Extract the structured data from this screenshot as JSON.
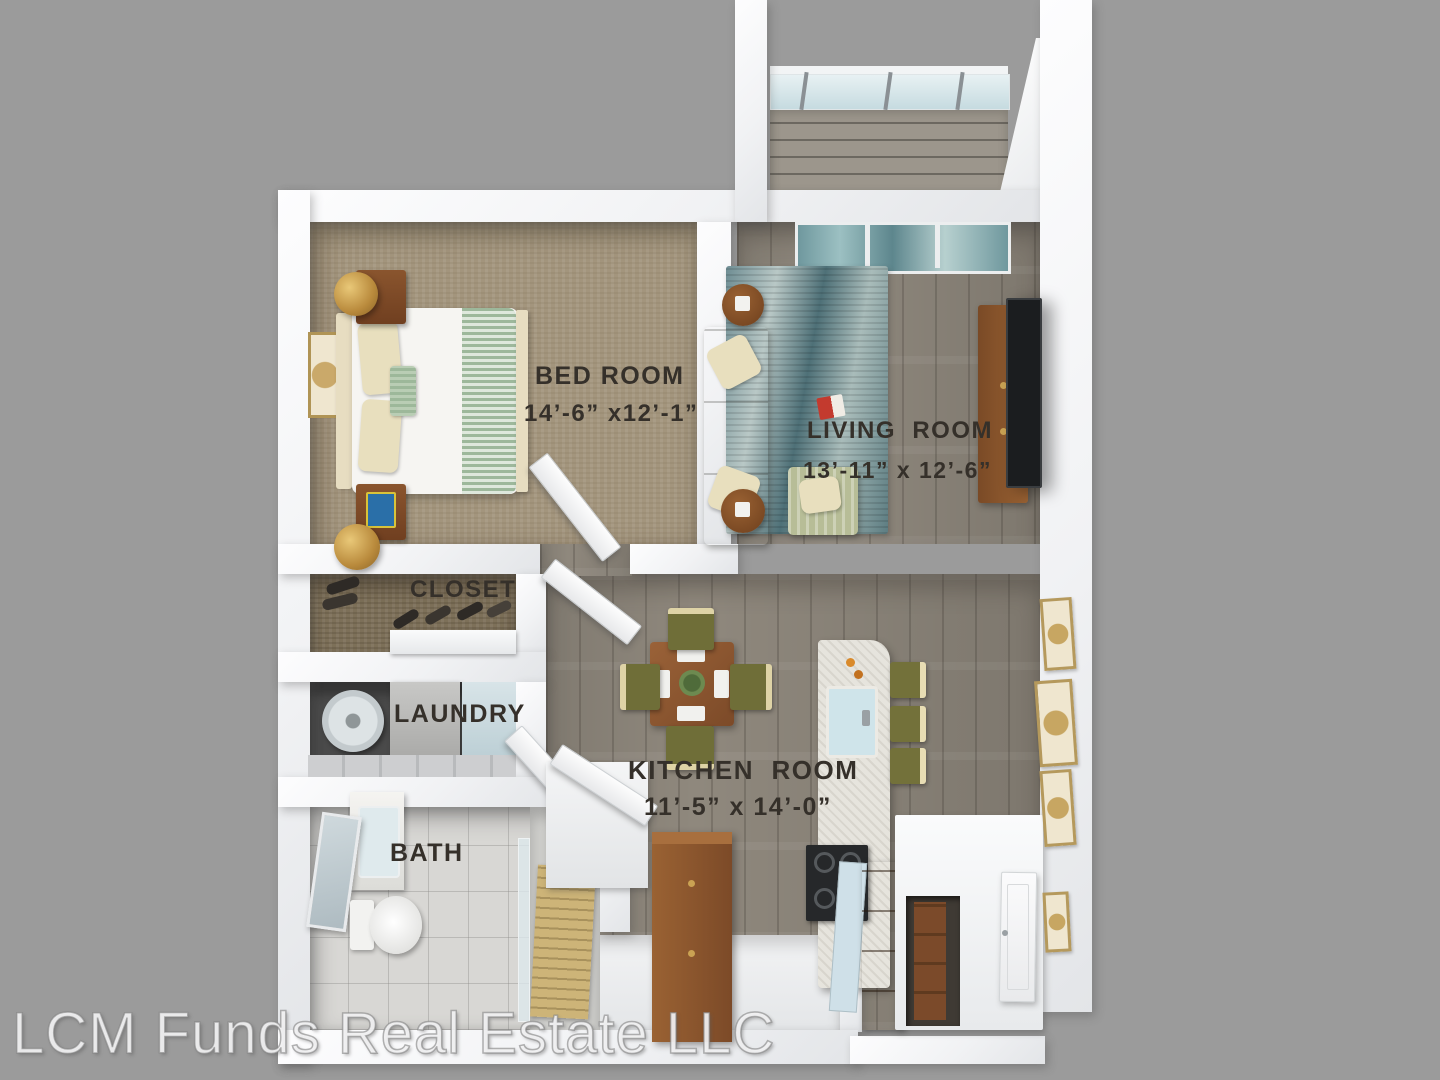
{
  "image": {
    "type": "3d-floorplan-top-view",
    "watermark": "LCM Funds Real Estate LLC",
    "background_color": "#9b9b9b",
    "wall_color": "#f4f5f7",
    "label_color": "#35302a"
  },
  "rooms": {
    "bedroom": {
      "label": "BED ROOM",
      "dimensions": "14’-6” x12’-1”"
    },
    "living": {
      "label": "LIVING  ROOM",
      "dimensions": "13’-11” x 12’-6”"
    },
    "closet": {
      "label": "CLOSET"
    },
    "laundry": {
      "label": "LAUNDRY"
    },
    "kitchen": {
      "label": "KITCHEN  ROOM",
      "dimensions": "11’-5” x 14’-0”"
    },
    "bath": {
      "label": "BATH"
    }
  },
  "palette": {
    "carpet": "#a3957d",
    "wood_floor": "#8f887d",
    "rug": "#5d7d82",
    "sofa": "#868c72",
    "cabinet_wood": "#8a5430",
    "marble_island": "#e6e4dd",
    "glass": "#cfe4ea",
    "lamp_gold": "#c9a050"
  }
}
